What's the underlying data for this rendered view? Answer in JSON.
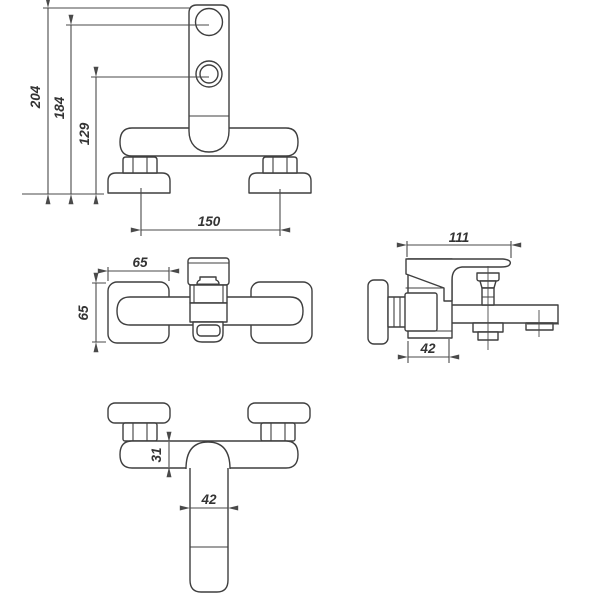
{
  "meta": {
    "background": "#ffffff",
    "line_color": "#3f3f3f",
    "description": "Dimensioned orthographic technical drawing of a wall-mounted bath mixer tap"
  },
  "views": {
    "front": {
      "label": "front view, handle up",
      "dims": {
        "overall_height": "204",
        "top_port_height": "184",
        "lower_port_height": "129",
        "union_centers": "150"
      }
    },
    "plan": {
      "label": "plan view",
      "dims": {
        "escutcheon_width": "65",
        "escutcheon_depth": "65"
      }
    },
    "side": {
      "label": "side view",
      "dims": {
        "overall_projection": "111",
        "body_depth": "42"
      }
    },
    "bottom": {
      "label": "front view, spout down",
      "dims": {
        "body_height": "31",
        "spout_width": "42"
      }
    }
  }
}
